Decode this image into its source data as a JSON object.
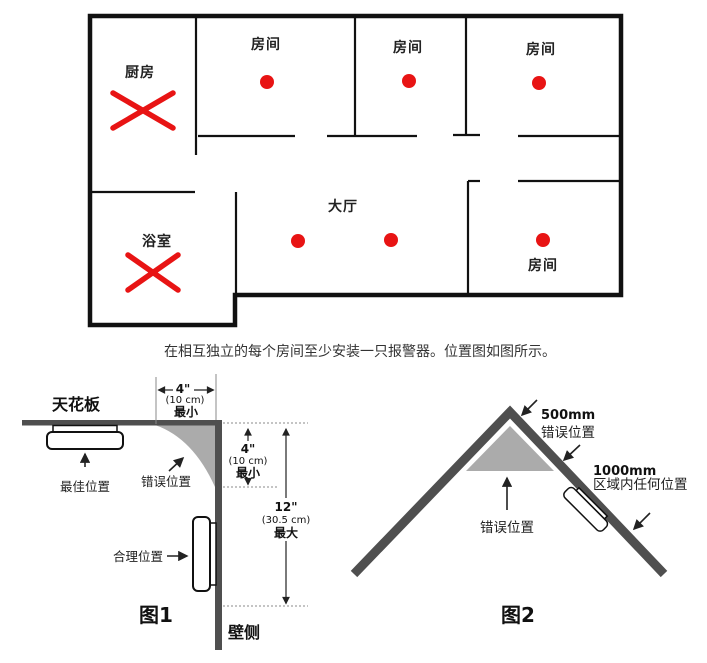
{
  "floor_plan": {
    "rooms": {
      "kitchen": "厨房",
      "room_top_1": "房间",
      "room_top_2": "房间",
      "room_top_3": "房间",
      "bathroom": "浴室",
      "hall": "大厅",
      "room_bottom_right": "房间"
    },
    "caption": "在相互独立的每个房间至少安装一只报警器。位置图如图所示。"
  },
  "figure1": {
    "title": "图1",
    "ceiling": "天花板",
    "wall": "壁侧",
    "best_position": "最佳位置",
    "wrong_position": "错误位置",
    "ok_position": "合理位置",
    "dim_top": [
      "4\"",
      "(10 cm)",
      "最小"
    ],
    "dim_side": [
      "4\"",
      "(10 cm)",
      "最小"
    ],
    "dim_wall": [
      "12\"",
      "(30.5 cm)",
      "最大"
    ]
  },
  "figure2": {
    "title": "图2",
    "apex_zone": [
      "500mm",
      "错误位置"
    ],
    "slope_zone": [
      "1000mm",
      "区域内任何位置"
    ],
    "wrong_position": "错误位置"
  },
  "colors": {
    "alarm_red": "#e81414",
    "structure_gray": "#4f4f4f",
    "shade_gray": "#ababab",
    "wall_black": "#111111"
  }
}
